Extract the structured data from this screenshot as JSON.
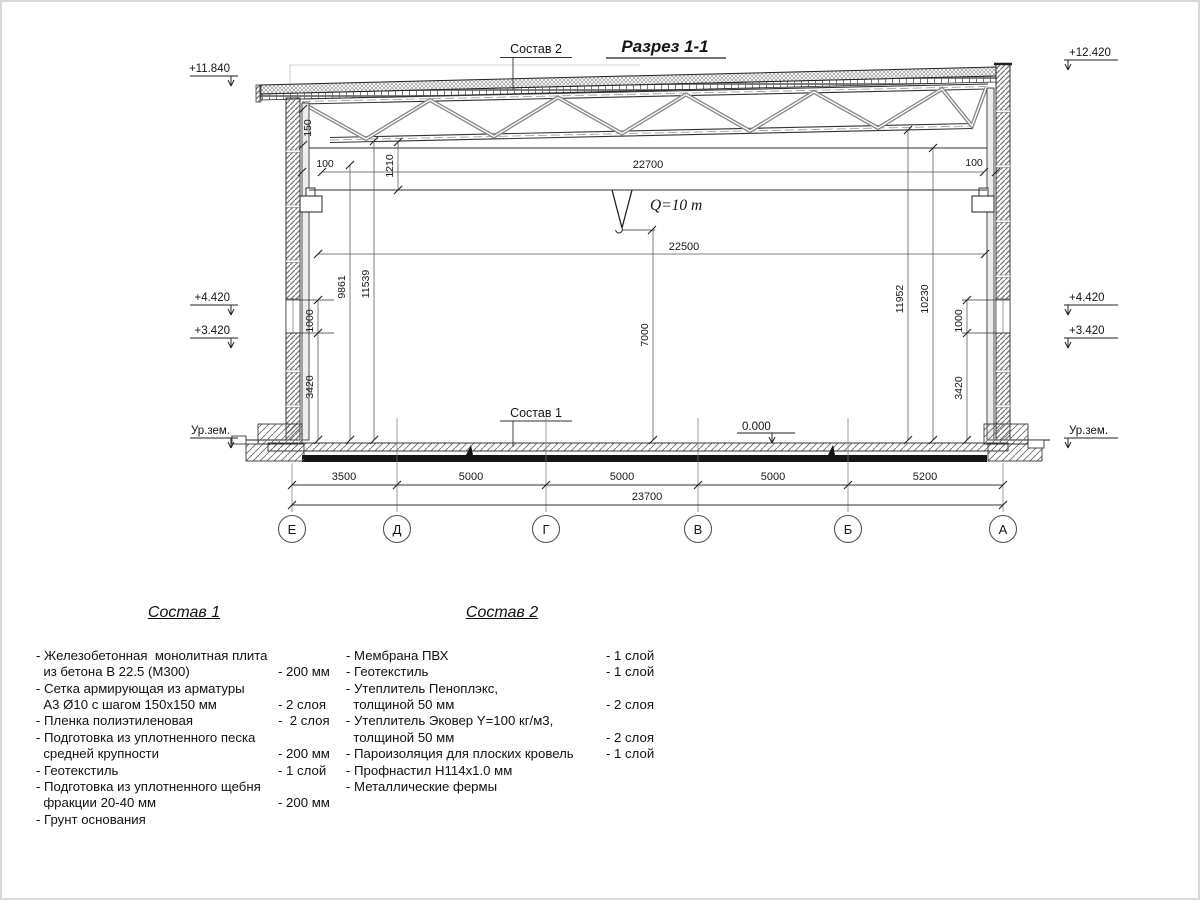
{
  "drawing": {
    "title": "Разрез 1-1",
    "labels": {
      "sostav2_ref": "Состав 2",
      "sostav1_ref": "Состав 1",
      "crane_capacity": "Q=10 т",
      "zero_level": "0.000"
    },
    "elevations": {
      "left_roof": "+11.840",
      "right_roof": "+12.420",
      "left_upper": "+4.420",
      "left_lower": "+3.420",
      "right_upper": "+4.420",
      "right_lower": "+3.420",
      "left_ground": "Ур.зем.",
      "right_ground": "Ур.зем."
    },
    "dims": {
      "truss_support": "150",
      "gap_left": "100",
      "gap_right": "100",
      "beam_depth": "1210",
      "runway_span": "22700",
      "crane_span": "22500",
      "left_rail_h": "9861",
      "left_total_h": "11539",
      "clear_h": "7000",
      "right_total_h": "11952",
      "right_rail_h": "10230",
      "left_window": "1000",
      "left_lower_h": "3420",
      "right_window": "1000",
      "right_lower_h": "3420"
    },
    "bottom_dims": [
      "3500",
      "5000",
      "5000",
      "5000",
      "5200"
    ],
    "total_dim": "23700",
    "axes": [
      "Е",
      "Д",
      "Г",
      "В",
      "Б",
      "А"
    ]
  },
  "sostav1": {
    "title": "Состав 1",
    "items": [
      {
        "text": "- Железобетонная  монолитная плита\n  из бетона В 22.5 (М300)",
        "qty": "- 200 мм"
      },
      {
        "text": "- Сетка армирующая из арматуры\n  А3 Ø10 с шагом 150х150 мм",
        "qty": "- 2 слоя"
      },
      {
        "text": "- Пленка полиэтиленовая",
        "qty": "-  2 слоя"
      },
      {
        "text": "- Подготовка из уплотненного песка\n  средней крупности",
        "qty": "- 200 мм"
      },
      {
        "text": "- Геотекстиль",
        "qty": "- 1 слой"
      },
      {
        "text": "- Подготовка из уплотненного щебня\n  фракции 20-40 мм",
        "qty": "- 200 мм"
      },
      {
        "text": "- Грунт основания",
        "qty": ""
      }
    ]
  },
  "sostav2": {
    "title": "Состав 2",
    "items": [
      {
        "text": "- Мембрана ПВХ",
        "qty": "- 1 слой"
      },
      {
        "text": "- Геотекстиль",
        "qty": "- 1 слой"
      },
      {
        "text": "- Утеплитель Пеноплэкс,\n  толщиной 50 мм",
        "qty": "- 2 слоя"
      },
      {
        "text": "- Утеплитель Эковер Y=100 кг/м3,\n  толщиной 50 мм",
        "qty": "- 2 слоя"
      },
      {
        "text": "- Пароизоляция для плоских кровель",
        "qty": "- 1 слой"
      },
      {
        "text": "- Профнастил Н114х1.0 мм",
        "qty": ""
      },
      {
        "text": "- Металлические фермы",
        "qty": ""
      }
    ]
  }
}
